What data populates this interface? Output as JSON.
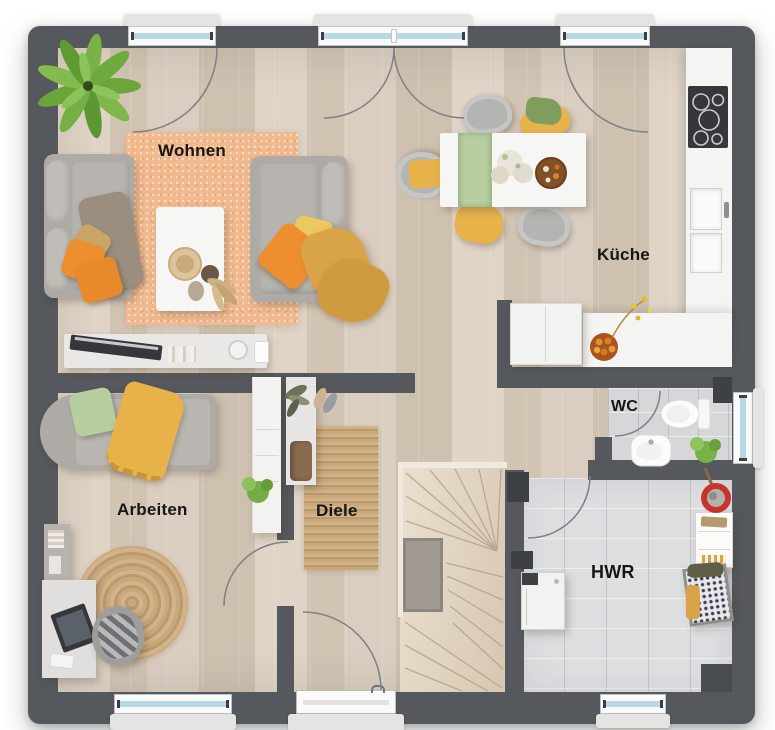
{
  "rooms": {
    "wohnen": {
      "label": "Wohnen"
    },
    "kueche": {
      "label": "Küche"
    },
    "arbeiten": {
      "label": "Arbeiten"
    },
    "diele": {
      "label": "Diele"
    },
    "wc": {
      "label": "WC"
    },
    "hwr": {
      "label": "HWR"
    }
  },
  "colors": {
    "page_bg": "#ffffff",
    "wall": "#55585c",
    "wall_dark": "#3d4044",
    "floor_wood": "#d8ccbd",
    "plank_light": "#dfd4c6",
    "plank_dark": "#d2c4b3",
    "tile": "#d5d7d9",
    "rug_living": "#f1ba8e",
    "rug_jute": "#c9a87c",
    "rug_jute_dark": "#bb9a6e",
    "counter": "#f4f4f2",
    "furniture_white": "#f6f6f4",
    "sofa": "#aeaba7",
    "sofa_light": "#c0bdb9",
    "accent_orange": "#ee8f2f",
    "accent_yellow": "#e8b24a",
    "accent_mustard": "#d9a348",
    "accent_green": "#b7cfa0",
    "green_cloth": "#7f9e5e",
    "plant_green": "#6fae3e",
    "window_glass": "#b8d8e8",
    "window_frame": "#fafafa",
    "sill": "#e4e4e2",
    "door_arc": "#7e8184",
    "stair_edge": "#b3a288",
    "mat_gray": "#a09a92",
    "appliance_dark": "#35373a",
    "red_bucket": "#c8342b",
    "brown_chair": "#8a6a4e",
    "label_color": "#161616"
  }
}
